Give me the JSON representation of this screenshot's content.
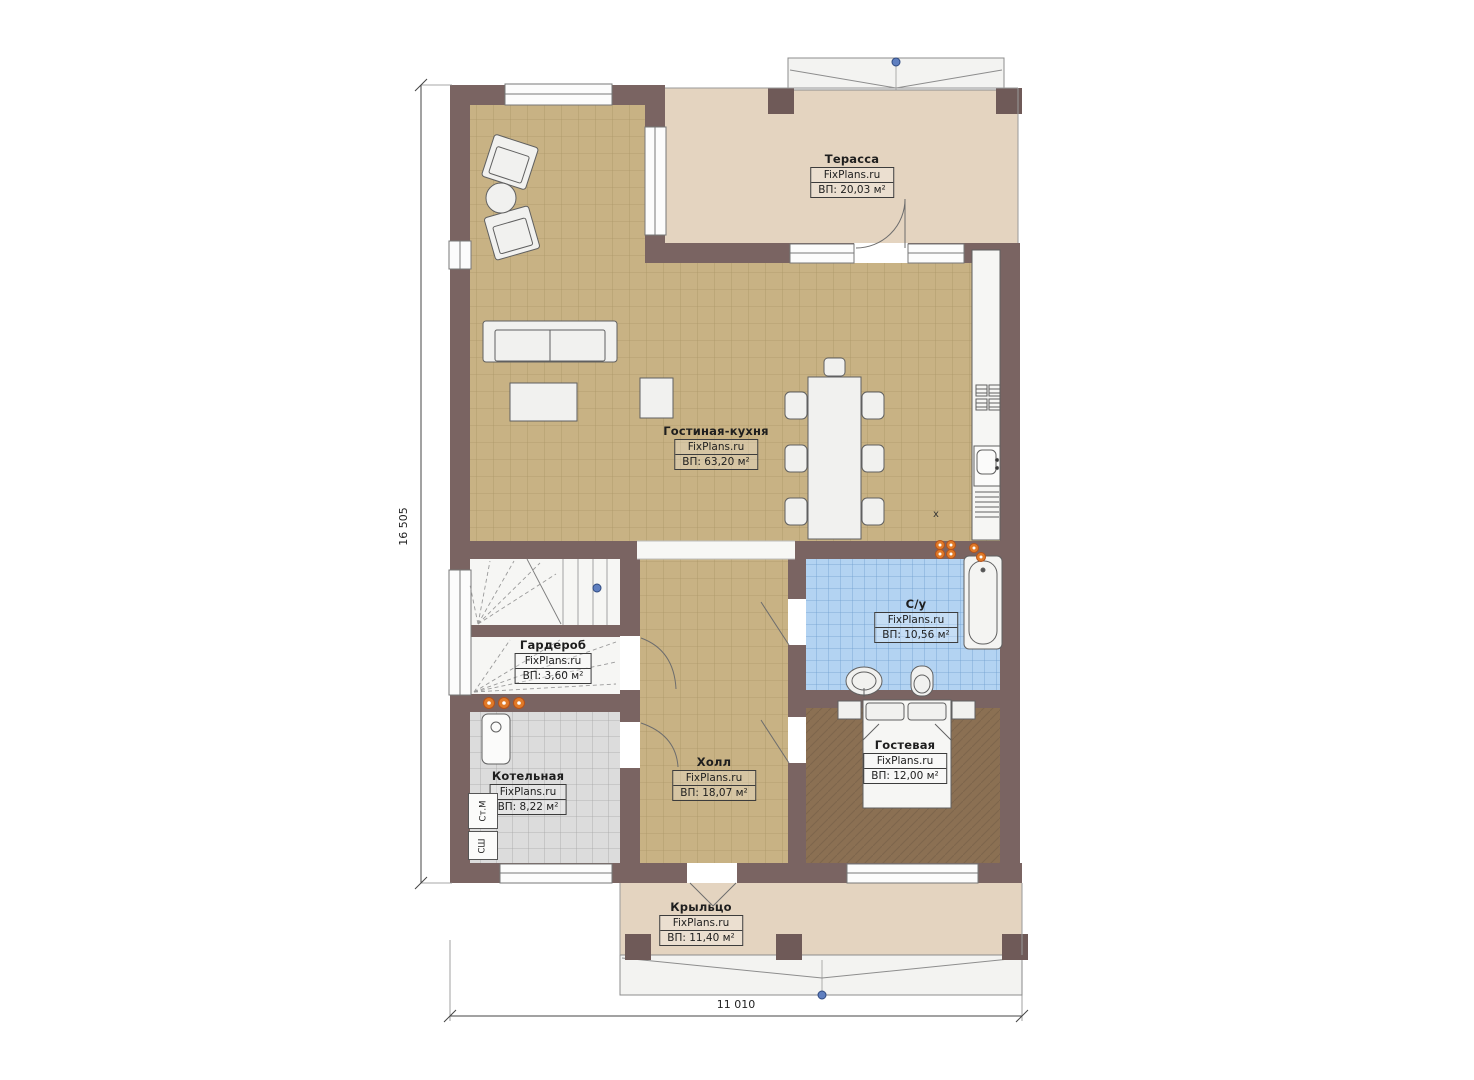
{
  "plan": {
    "brand": "FixPlans.ru",
    "rooms": [
      {
        "id": "terrace",
        "name": "Терасса",
        "area": "ВП: 20,03 м²"
      },
      {
        "id": "living-kitchen",
        "name": "Гостиная-кухня",
        "area": "ВП: 63,20 м²"
      },
      {
        "id": "bathroom",
        "name": "С/у",
        "area": "ВП: 10,56 м²"
      },
      {
        "id": "wardrobe",
        "name": "Гардероб",
        "area": "ВП: 3,60 м²"
      },
      {
        "id": "boiler-room",
        "name": "Котельная",
        "area": "ВП: 8,22 м²"
      },
      {
        "id": "hall",
        "name": "Холл",
        "area": "ВП: 18,07 м²"
      },
      {
        "id": "guest-room",
        "name": "Гостевая",
        "area": "ВП: 12,00 м²"
      },
      {
        "id": "porch",
        "name": "Крыльцо",
        "area": "ВП: 11,40 м²"
      }
    ],
    "dimensions": {
      "height": "16 505",
      "width": "11 010"
    },
    "appliances": {
      "washer": "Ст.М",
      "dryer": "СШ",
      "kitchen_marker": "x"
    },
    "colors": {
      "wall": "#7a6462",
      "tan_tile": "#c8b284",
      "terrace_floor": "#e4d4c0",
      "bath_tile": "#b3d3f2",
      "boiler_tile": "#dcdcdc",
      "guest_floor": "#8b7053",
      "radiator_dot": "#e07a28",
      "marker_dot": "#5f7fc0"
    }
  }
}
